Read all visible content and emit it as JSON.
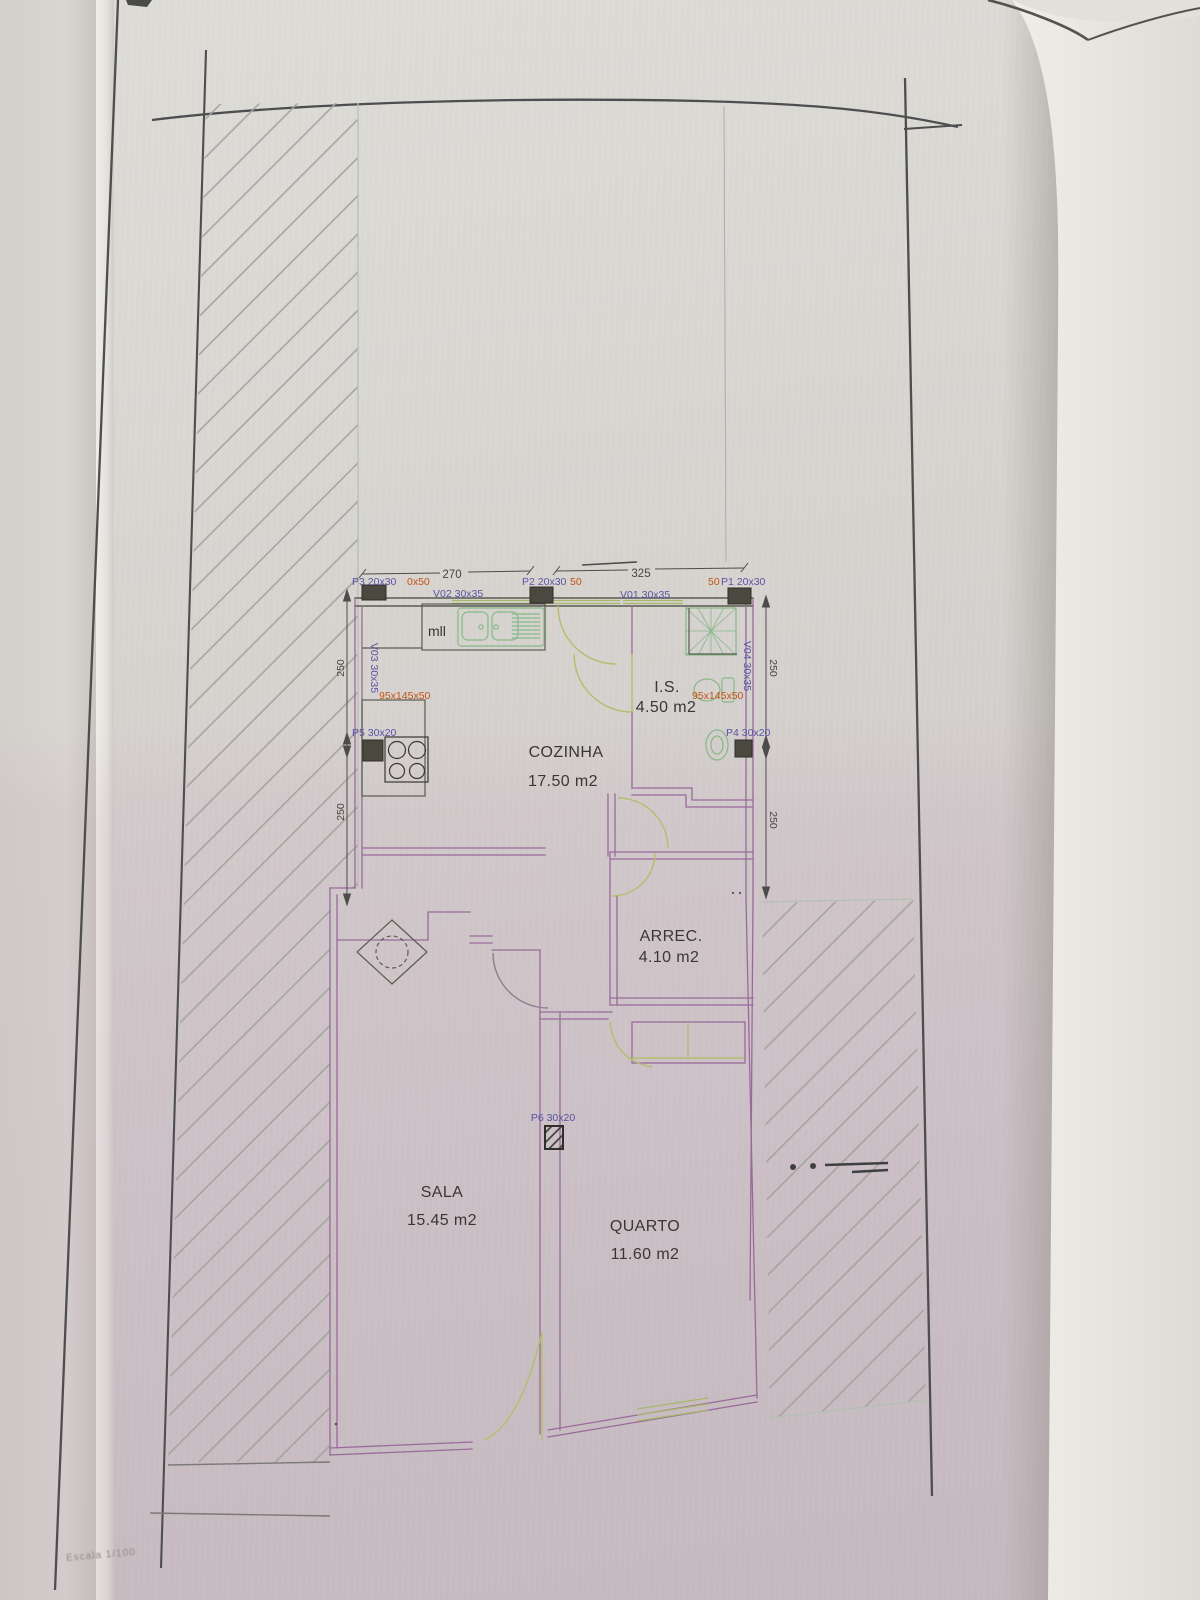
{
  "photo": {
    "scale_note": "Escala 1/100"
  },
  "plan": {
    "rooms": [
      {
        "id": "cozinha",
        "name": "COZINHA",
        "area": "17.50 m2"
      },
      {
        "id": "is",
        "name": "I.S.",
        "area": "4.50 m2"
      },
      {
        "id": "arrec",
        "name": "ARREC.",
        "area": "4.10 m2"
      },
      {
        "id": "sala",
        "name": "SALA",
        "area": "15.45 m2"
      },
      {
        "id": "quarto",
        "name": "QUARTO",
        "area": "11.60 m2"
      }
    ],
    "doors": {
      "p1": "P1 20x30",
      "p2": "P2 20x30",
      "p3": "P3 20x30",
      "p4": "P4 30x20",
      "p5": "P5 30x20",
      "p6": "P6 30x20"
    },
    "windows": {
      "v01": "V01 30x35",
      "v02": "V02 30x35",
      "v03": "V03 30x35",
      "v04": "V04 30x35"
    },
    "red_annotations": {
      "after_p3": "0x50",
      "after_p2": "50",
      "before_p1": "50",
      "kitchen_counter": "95x145x50",
      "bathroom_counter": "95x145x50"
    },
    "dimensions": {
      "top_left_span": "270",
      "top_right_span": "325",
      "left_upper": "250",
      "left_lower": "250",
      "right_upper": "250",
      "right_lower": "250"
    },
    "kitchen": {
      "appliance_label": "mll"
    }
  },
  "colors": {
    "paper": "#d7d4cf",
    "pink_cast": "#cfc3cc",
    "curled_page": "#ece9e3",
    "ink_border": "#4e4e50",
    "wall_purple": "#9a6a9a",
    "wall_dark": "#5a5b52",
    "fixture_green": "#87b989",
    "door_green": "#b5bd6d",
    "hatch_gray": "#a3a29e",
    "label_blue": "#5a52a5",
    "note_red": "#c35315",
    "text_black": "#3a3732"
  }
}
